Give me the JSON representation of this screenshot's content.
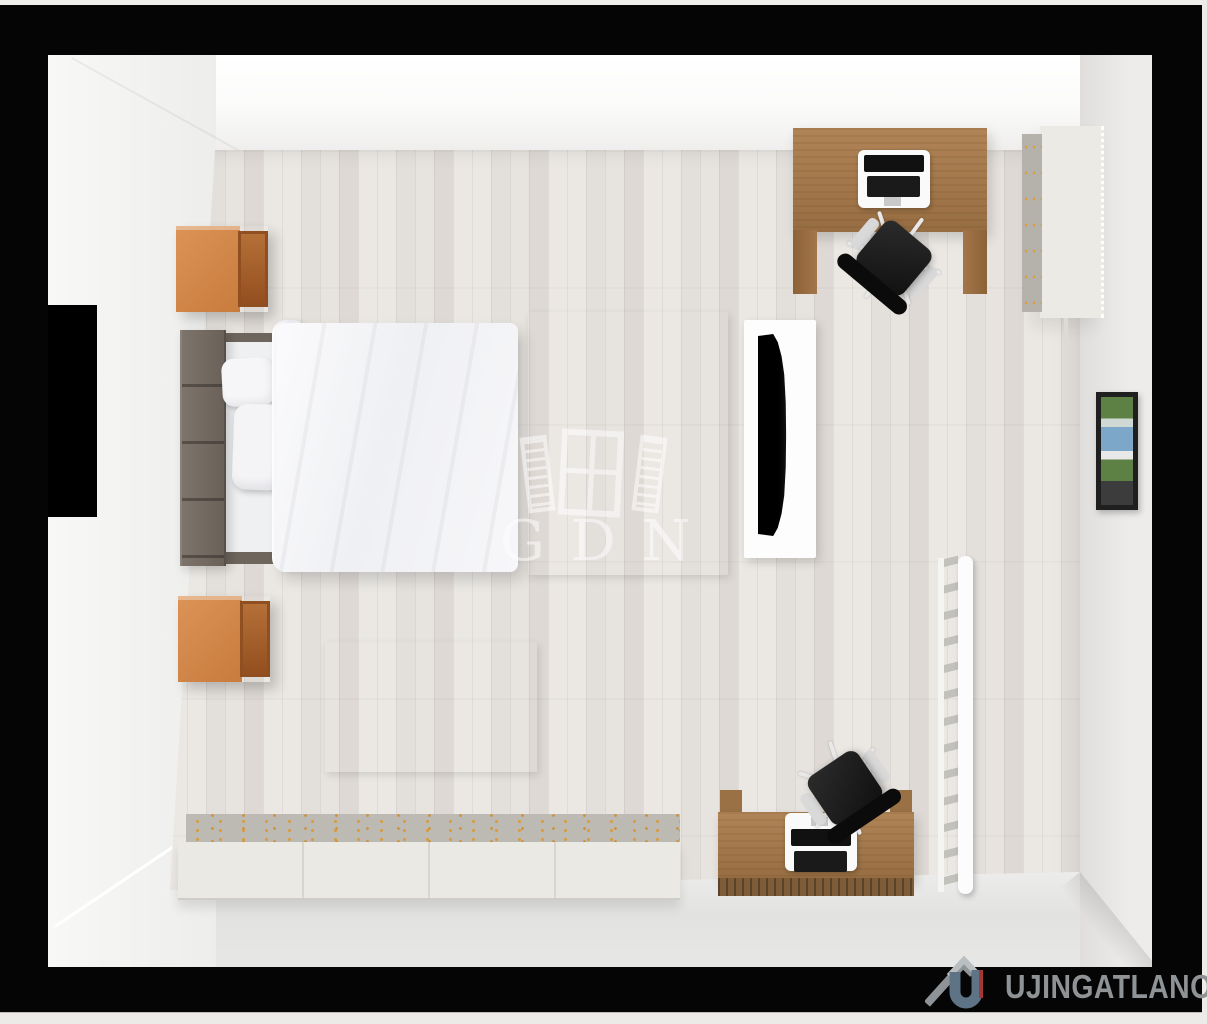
{
  "watermark": {
    "text": "GDN",
    "icon": "open-window-icon",
    "color": "#ffffff"
  },
  "brand": {
    "text": "UJINGATLANOK.HU",
    "icon": "house-u-logo-icon",
    "text_color": "#8f9396"
  },
  "scene": {
    "type": "3d-floorplan-top-down-render",
    "room": "bedroom-office",
    "frame_color": "#050505",
    "floor_color": "#e7e3df",
    "wall_color": "#f6f6f5"
  },
  "rugs": {
    "large": {
      "cols": 4,
      "rows": [
        [
          "#2095c3",
          "#0f7ea6",
          "#0f7ea6",
          "#29a7d4"
        ],
        [
          "#abdeec",
          "#c7ebf3",
          "#2aa0cb",
          "#29a7d4"
        ],
        [
          "#abdeec",
          "#0c6f92",
          "#0c6f92",
          "#2fb0da"
        ],
        [
          "#35a8d3",
          "#2095c3",
          "#a5dbe9",
          "#2fb0da"
        ],
        [
          "#2095c3",
          "#2aa0cb",
          "#1b89b1",
          "#0c6f92"
        ]
      ]
    },
    "small": {
      "cols": 6,
      "rows": [
        [
          "#2095c3",
          "#29a7d4",
          "#b7e4ee",
          "#b7e4ee",
          "#29a7d4",
          "#0f7ea6"
        ],
        [
          "#0f7ea6",
          "#29a7d4",
          "#0c7397",
          "#29a7d4",
          "#b7e4ee",
          "#2095c3"
        ],
        [
          "#0f7ea6",
          "#29a7d4",
          "#b7e4ee",
          "#0c7397",
          "#29a7d4",
          "#2095c3"
        ],
        [
          "#0c7397",
          "#2095c3",
          "#29a7d4",
          "#29a7d4",
          "#2aa0cb",
          "#29a7d4"
        ]
      ]
    }
  },
  "furniture": [
    {
      "name": "double-bed",
      "colors": [
        "#6a6159",
        "#f4f3f6"
      ]
    },
    {
      "name": "nightstand",
      "count": 2,
      "color": "#c87c3e"
    },
    {
      "name": "patchwork-rug-large",
      "color": "#29a7d4"
    },
    {
      "name": "patchwork-rug-small",
      "color": "#29a7d4"
    },
    {
      "name": "tv-on-white-board",
      "colors": [
        "#fdfdfd",
        "#0a0a0a"
      ]
    },
    {
      "name": "computer-desk-top-right",
      "color": "#a1764a"
    },
    {
      "name": "office-chair",
      "count": 2,
      "color": "#171717"
    },
    {
      "name": "wardrobe",
      "color": "#eceae4"
    },
    {
      "name": "wall-picture",
      "colors": [
        "#5d8044",
        "#7ca7c8"
      ]
    },
    {
      "name": "ladder-rack",
      "color": "#fbfbfb"
    },
    {
      "name": "computer-desk-bottom-right",
      "color": "#a1764a"
    },
    {
      "name": "storage-sideboard",
      "colors": [
        "#ebe9e3",
        "#d89b3e"
      ]
    }
  ]
}
